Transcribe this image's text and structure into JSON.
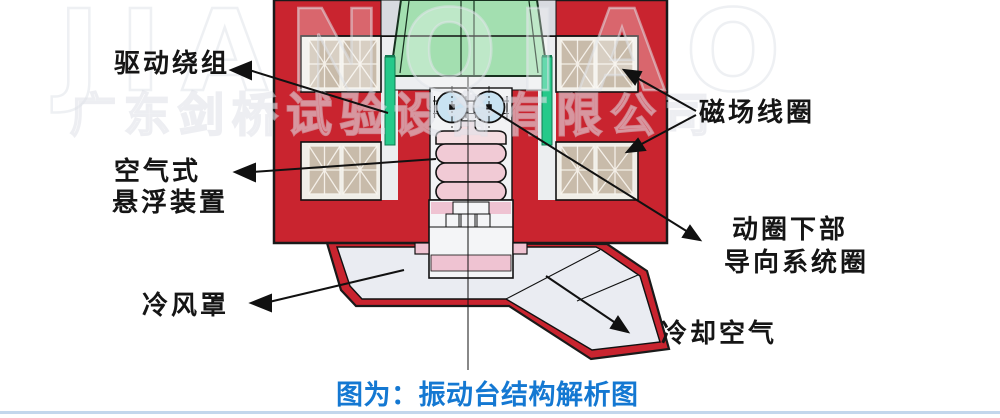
{
  "watermark": {
    "brand": "JIANQIAO",
    "company": "广东剑桥试验设备有限公司"
  },
  "labels": {
    "drive_winding": "驱动绕组",
    "air_suspension": [
      "空气式",
      "悬浮装置"
    ],
    "field_coil": "磁场线圈",
    "moving_coil_guide": [
      "动圈下部",
      "导向系统圈"
    ],
    "cold_air_hood": "冷风罩",
    "cooling_air": "冷却空气"
  },
  "caption": "图为：振动台结构解析图",
  "colors": {
    "body_red": "#c9242f",
    "armature_green": "#a3dfb0",
    "drive_coil_green": "#25c98a",
    "coil_block_tan": "#c8bbaa",
    "slot_background": "#f0eee8",
    "bearing_blue": "#c9e3f2",
    "bellows_pink": "#f1cad5",
    "band_pink": "#efc3d2",
    "hood_gray": "#eaecf2",
    "caption_blue": "#1478d2",
    "bottom_rule_blue": "#c3d7ec"
  }
}
